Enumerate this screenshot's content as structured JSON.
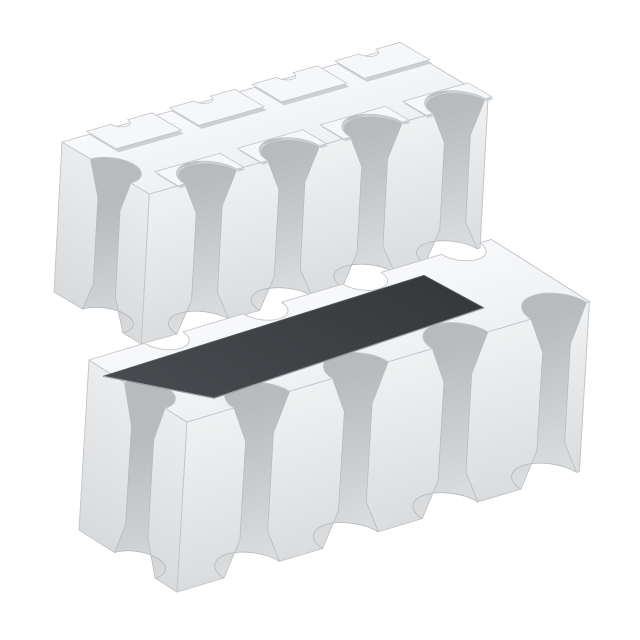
{
  "meta": {
    "title": "Chip resistor network array product photo",
    "description": "Two isometric views of an 8-terminal white ceramic chip resistor array package: the upper-left unit is flipped bottom-side up showing raised castellated solder pads, the lower-right unit is top-side up showing its dark resistive element coating.",
    "background_color": "#ffffff"
  },
  "illustration": {
    "canvas": {
      "width": 640,
      "height": 640
    },
    "colors": {
      "background": "#ffffff",
      "edge_stroke": "#c2c5c8",
      "edge_stroke_soft": "#b4b8ba",
      "top_light": "#f8f9fa",
      "top_dark": "#eef0f2",
      "front_light": "#eff1f2",
      "front_dark": "#dadcde",
      "groove_dark": "#b7bbbd",
      "groove_light": "#dcdee0",
      "end_left_light": "#eaecee",
      "end_left_dark": "#d8dadc",
      "end_right_light": "#f3f4f5",
      "end_right_dark": "#e4e6e8",
      "coat_light": "#474a4e",
      "coat_dark": "#36393c",
      "coat_edge": "#53575a",
      "coat_rim": "#9ba0a4",
      "pad_fill": "#f6f7f8",
      "pad_side": "#cdd0d2"
    },
    "components": [
      {
        "name": "resistor-array-bottom-view",
        "origin": [
          62,
          142
        ],
        "u_axis": [
          0.962,
          -0.273
        ],
        "v_axis": [
          0.84,
          0.5
        ],
        "length": 352,
        "width": 104,
        "depth": [
          -8,
          150
        ],
        "groove_radius": 27,
        "groove_centers": [
          64,
          150,
          236,
          322
        ],
        "back_notches": [],
        "back_notch_radius": 8.5,
        "end_notch": {
          "v": 58,
          "radius": 24
        },
        "pads": {
          "centers": [
            64,
            150,
            236,
            322
          ],
          "half_width": 34,
          "v0": -5,
          "v1": 30,
          "notch_radius": 8.5,
          "front_plate_depth": 28
        },
        "coat": null
      },
      {
        "name": "resistor-array-top-view",
        "origin": [
          89,
          360
        ],
        "u_axis": [
          0.958,
          -0.287
        ],
        "v_axis": [
          0.845,
          0.535
        ],
        "length": 420,
        "width": 116,
        "depth": [
          -10,
          170
        ],
        "groove_radius": 29,
        "groove_centers": [
          78,
          181,
          285,
          388
        ],
        "back_notches": [
          78,
          181,
          285,
          388
        ],
        "back_notch_radius": 20,
        "end_notch": {
          "v": 66,
          "radius": 24
        },
        "pads": null,
        "coat": {
          "points": [
            [
              -8,
              26
            ],
            [
              332,
              20
            ],
            [
              338,
              84
            ],
            [
              46,
              96
            ]
          ]
        }
      }
    ]
  }
}
